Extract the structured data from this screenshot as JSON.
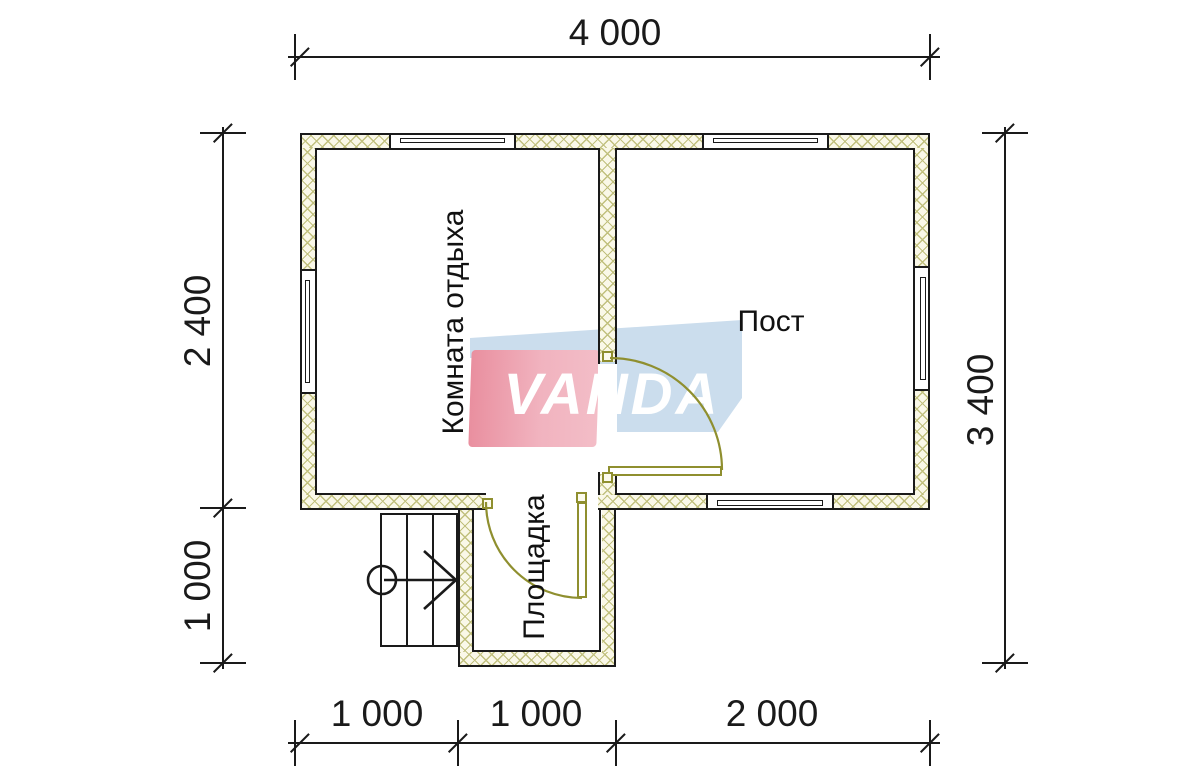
{
  "watermark": {
    "text": "VANDA"
  },
  "rooms": {
    "lounge": {
      "label": "Комната отдыха",
      "orientation": "vertical"
    },
    "post": {
      "label": "Пост",
      "orientation": "horizontal"
    },
    "porch": {
      "label": "Площадка",
      "orientation": "vertical"
    }
  },
  "dimensions": {
    "top": {
      "label": "4 000"
    },
    "left_upper": {
      "label": "2 400"
    },
    "left_lower": {
      "label": "1 000"
    },
    "right": {
      "label": "3 400"
    },
    "bottom_left": {
      "label": "1 000"
    },
    "bottom_mid": {
      "label": "1 000"
    },
    "bottom_right": {
      "label": "2 000"
    }
  },
  "colors": {
    "line": "#1a1a1a",
    "wall_hatch_line": "#c1c07e",
    "wall_fill": "#faf8e8",
    "door": "#8f8f2f",
    "logo_pink": "#f1b3bf",
    "logo_pink_dark": "#e98f9f",
    "logo_blue": "#cbdded",
    "logo_text_color": "#ffffff"
  }
}
